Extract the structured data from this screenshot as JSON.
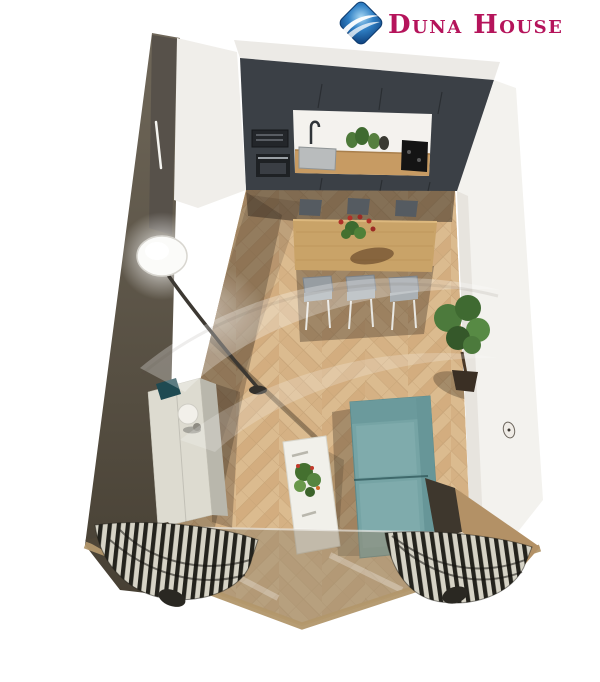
{
  "logo": {
    "text": "Duna House",
    "text_color": "#b5145b",
    "mark": "blue-diamond-wave",
    "mark_color": "#1b5ea8"
  },
  "watermark": {
    "name": "duna-house-wave-watermark",
    "opacity": 0.28
  },
  "scene": {
    "kind": "3d-room-render-top-view",
    "areas": [
      "open kitchen",
      "dining area",
      "living area",
      "balcony window wall"
    ],
    "objects": [
      "kitchen cabinets",
      "built-in oven",
      "microwave",
      "kitchen sink",
      "faucet",
      "black cooktop",
      "counter plants",
      "wooden dining table",
      "dining chairs",
      "flower centerpiece",
      "arc floor lamp",
      "white sideboard",
      "table lamp",
      "potted tree",
      "wall clock",
      "teal sofa",
      "white coffee table",
      "coffee table plant",
      "striped curtains",
      "glass balcony wall",
      "herringbone parquet floor"
    ],
    "palette": {
      "floor": "#d9b88b",
      "kitchen_wall": "#3b4046",
      "side_wall_dark": "#5e574c",
      "wall_white": "#f3f2ee",
      "sofa_teal": "#76a4a5",
      "table_wood": "#c9a368",
      "curtain_dark": "#24231d",
      "curtain_light": "#d6d3c6",
      "frame_tan": "#b2976c"
    }
  }
}
